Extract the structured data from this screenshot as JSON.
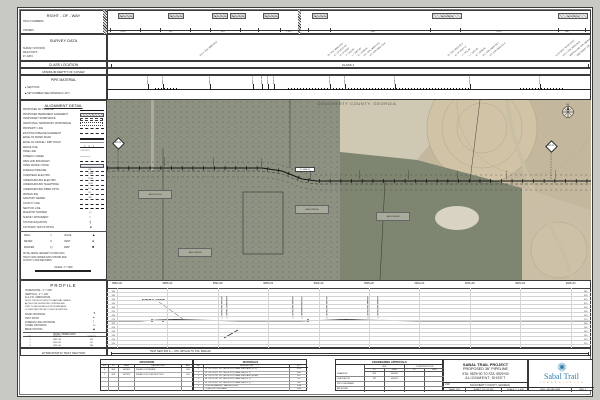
{
  "page": {
    "outer_bg": "#c9c9c3",
    "sheet_bg": "#ffffff",
    "line_color": "#2b2b2b"
  },
  "top": {
    "right_of_way": {
      "title": "RIGHT - OF - WAY",
      "sub1": "TRACT NUMBERS",
      "sub2": "OWNERS",
      "tracts": [
        {
          "x": 118,
          "w": 16,
          "label": "GA-DO-279.000"
        },
        {
          "x": 168,
          "w": 16,
          "label": "GA-DO-280.000"
        },
        {
          "x": 212,
          "w": 16,
          "label": "GA-DO-281.000"
        },
        {
          "x": 230,
          "w": 16,
          "label": "GA-DO-282.000"
        },
        {
          "x": 263,
          "w": 16,
          "label": "GA-DO-283.000"
        },
        {
          "x": 312,
          "w": 16,
          "label": "GA-DO-284.000"
        },
        {
          "x": 432,
          "w": 30,
          "label": "GA-DO-285.000"
        },
        {
          "x": 558,
          "w": 30,
          "label": "GA-DO-287.000"
        }
      ],
      "ticks": [
        110,
        140,
        160,
        190,
        210,
        240,
        258,
        280,
        308,
        330,
        430,
        460,
        558,
        585
      ],
      "distances": [
        {
          "x": 122,
          "label": "1,023'"
        },
        {
          "x": 170,
          "label": "612'"
        },
        {
          "x": 222,
          "label": "418'"
        },
        {
          "x": 288,
          "label": "1,495'"
        },
        {
          "x": 372,
          "label": "2,847'"
        },
        {
          "x": 498,
          "label": "3,214'"
        },
        {
          "x": 566,
          "label": "986'"
        }
      ]
    },
    "survey": {
      "title": "SURVEY DATA",
      "sub1": "SURVEY STATIONS",
      "sub2": "MILE POSTS",
      "sub3": "P.I. DATA",
      "diagonals": [
        {
          "x": 200,
          "text": "P.O.T. STA. 9888+50.0"
        },
        {
          "x": 328,
          "text": "P.I. STA. 9896+45.8"
        },
        {
          "x": 334,
          "text": "Δ = 12°30'15\" RT"
        },
        {
          "x": 340,
          "text": "D = 0°45'00\""
        },
        {
          "x": 346,
          "text": "T = 833.25'"
        },
        {
          "x": 352,
          "text": "L = 1667.00'"
        },
        {
          "x": 358,
          "text": "R = 7639.44'"
        },
        {
          "x": 364,
          "text": "P.C. STA. 9888+12.6"
        },
        {
          "x": 370,
          "text": "P.T. STA. 9904+79.6"
        },
        {
          "x": 448,
          "text": "P.I. STA. 9915+02.3"
        },
        {
          "x": 455,
          "text": "Δ = 8°15'40\" LT"
        },
        {
          "x": 462,
          "text": "T = 551.60'"
        },
        {
          "x": 469,
          "text": "L = 1101.48'"
        },
        {
          "x": 476,
          "text": "R = 7639.44'"
        },
        {
          "x": 483,
          "text": "P.C. STA. 9909+50.7"
        },
        {
          "x": 490,
          "text": "P.T. STA. 9920+52.2"
        },
        {
          "x": 556,
          "text": "N 31°34'21\" W 84°15'12\""
        },
        {
          "x": 563,
          "text": "P.O.T. STA. 9925+00.0"
        },
        {
          "x": 570,
          "text": "MATCH LINE STA. 9929+00"
        },
        {
          "x": 577,
          "text": "SEE SHEET 116"
        }
      ]
    },
    "class_location": {
      "title": "CLASS LOCATION",
      "value": "CLASS 1"
    },
    "depth": {
      "title": "MINIMUM DEPTH OF COVER"
    },
    "pipe_material": {
      "title": "PIPE MATERIAL",
      "bullet1": "SECTIONS",
      "bullet2": "SET NUMBER (SEE MATERIALS LIST)",
      "callouts": [
        {
          "x": 148,
          "t": "9883+10 SET 1"
        },
        {
          "x": 163,
          "t": "9884+55 SET 2"
        },
        {
          "x": 210,
          "t": "9889+62 SET 1"
        },
        {
          "x": 253,
          "t": "9893+95 SET 3"
        },
        {
          "x": 262,
          "t": "9894+88 SET 3"
        },
        {
          "x": 268,
          "t": "9895+40 SET 2"
        },
        {
          "x": 274,
          "t": "9896+02 SET 1"
        },
        {
          "x": 330,
          "t": "9901+66 SET 1"
        },
        {
          "x": 345,
          "t": "9903+18 SET 2"
        },
        {
          "x": 395,
          "t": "9908+25 SET 1"
        },
        {
          "x": 470,
          "t": "9915+80 SET 2"
        },
        {
          "x": 540,
          "t": "9922+91 SET 1"
        }
      ],
      "dot_runs": [
        [
          155,
          178
        ],
        [
          288,
          470
        ],
        [
          520,
          565
        ]
      ]
    }
  },
  "legend": {
    "title": "ALIGNMENT DETAIL",
    "items": [
      {
        "label": "PROPOSED 36\" PIPELINE",
        "sym": "solid2"
      },
      {
        "label": "PROPOSED PERMANENT EASEMENT",
        "sym": "hatchbox"
      },
      {
        "label": "TEMPORARY WORKSPACE",
        "sym": "dashbox"
      },
      {
        "label": "ADDITIONAL TEMPORARY WORKSPACE",
        "sym": "dotbox"
      },
      {
        "label": "PROPERTY LINE",
        "sym": "dashdot"
      },
      {
        "label": "EXISTING PIPELINE EASEMENT",
        "sym": "dashed"
      },
      {
        "label": "EDGE OF PAVED ROAD",
        "sym": "double"
      },
      {
        "label": "EDGE OF GRAVEL / DIRT ROAD",
        "sym": "gray"
      },
      {
        "label": "FENCE LINE",
        "sym": "xline"
      },
      {
        "label": "TREE LINE",
        "sym": "scallop"
      },
      {
        "label": "STREAM / CREEK",
        "sym": "wavy"
      },
      {
        "label": "WETLAND BOUNDARY",
        "sym": "dash"
      },
      {
        "label": "OPEN WATER / POND",
        "sym": "hatch"
      },
      {
        "label": "FOREIGN PIPELINE",
        "sym": "FP"
      },
      {
        "label": "OVERHEAD ELECTRIC",
        "sym": "OHE"
      },
      {
        "label": "UNDERGROUND ELECTRIC",
        "sym": "UGE"
      },
      {
        "label": "UNDERGROUND TELEPHONE",
        "sym": "UGT"
      },
      {
        "label": "UNDERGROUND FIBER OPTIC",
        "sym": "FO"
      },
      {
        "label": "WATER LINE",
        "sym": "W"
      },
      {
        "label": "SANITARY SEWER",
        "sym": "SS"
      },
      {
        "label": "COUNTY LINE",
        "sym": "dd2"
      },
      {
        "label": "SECTION LINE",
        "sym": "longdash"
      },
      {
        "label": "MILEPOST MARKER",
        "sym": "diamond"
      },
      {
        "label": "SURVEY MONUMENT",
        "sym": "circle"
      },
      {
        "label": "STATION EQUATION",
        "sym": "tick"
      },
      {
        "label": "CATHODIC TEST STATION",
        "sym": "square"
      }
    ],
    "symbols2": [
      {
        "label": "WELL",
        "glyph": "○"
      },
      {
        "label": "VALVE",
        "glyph": "▲"
      },
      {
        "label": "METER",
        "glyph": "□"
      },
      {
        "label": "VENT",
        "glyph": "●"
      },
      {
        "label": "MARKER",
        "glyph": "◇"
      },
      {
        "label": "DRIP",
        "glyph": "■"
      }
    ],
    "note_lines": [
      "NOTE: AERIAL IMAGERY FLOWN 2013.",
      "TRACT AND OWNER DATA SHOWN PER",
      "COUNTY LAND RECORDS."
    ],
    "scale_text": "SCALE: 1\" = 600'"
  },
  "map": {
    "county": "DOUGHERTY COUNTY, GEORGIA",
    "compass": "N",
    "mileposts": [
      {
        "x": 118,
        "y": 143,
        "label": "MP 88"
      },
      {
        "x": 551,
        "y": 146,
        "label": "MP 89"
      }
    ],
    "stations": [
      {
        "x": 165,
        "y": 166,
        "label": "9885+00"
      },
      {
        "x": 214,
        "y": 166,
        "label": "9890+00"
      },
      {
        "x": 262,
        "y": 167,
        "label": "9895+00"
      },
      {
        "x": 311,
        "y": 179,
        "label": "9900+00"
      },
      {
        "x": 360,
        "y": 179,
        "label": "9905+00"
      },
      {
        "x": 409,
        "y": 179,
        "label": "9910+00"
      },
      {
        "x": 458,
        "y": 179,
        "label": "9915+00"
      },
      {
        "x": 507,
        "y": 179,
        "label": "9920+00"
      },
      {
        "x": 556,
        "y": 179,
        "label": "9925+00"
      }
    ],
    "owner_boxes": [
      {
        "x": 295,
        "y": 205,
        "label": "GA-DO-282.000"
      },
      {
        "x": 376,
        "y": 212,
        "label": "GA-DO-283.000"
      },
      {
        "x": 138,
        "y": 190,
        "label": "GA-DO-279.000"
      },
      {
        "x": 178,
        "y": 248,
        "label": "GA-DO-280.000"
      }
    ],
    "pi_label": "P.I. 9896+12",
    "pipeline_px": "107,168 262,168 282,171 302,179 317,181 591,181"
  },
  "profile": {
    "title": "PROFILE",
    "scale_h": "HORIZONTAL: 1\" = 600'",
    "scale_v": "VERTICAL: 1\" = 100'",
    "datum": "N.A.V.D. 1988 DATUM",
    "note_lines": [
      "NOTE: PROFILE DEPICTS NATURAL GRADE",
      "ALONG THE SURVEYED CENTERLINE.",
      "PIPE TO BE INSTALLED WITH MINIMUM",
      "COVER PER PROJECT SPECIFICATIONS."
    ],
    "legend": [
      {
        "label": "ROAD CROSSING",
        "glyph": "▼"
      },
      {
        "label": "TEST POINT",
        "glyph": "●"
      },
      {
        "label": "FOREIGN LINE CROSSING",
        "glyph": "|"
      },
      {
        "label": "CASED CROSSING",
        "glyph": "▭"
      },
      {
        "label": "BEND STATION",
        "glyph": "◆"
      }
    ],
    "table": {
      "title": "ROAD / BORE DATA",
      "cols": [
        "NO.",
        "STATION",
        "LENGTH"
      ],
      "widths": [
        14,
        40,
        29
      ],
      "rows": [
        [
          "1",
          "9891+58",
          "120'"
        ],
        [
          "2",
          "9907+81",
          "95'"
        ],
        [
          "3",
          "9921+40",
          "140'"
        ]
      ]
    },
    "stations": [
      "9880+00",
      "9885+00",
      "9890+00",
      "9895+00",
      "9900+00",
      "9905+00",
      "9910+00",
      "9915+00",
      "9920+00",
      "9925+00"
    ],
    "elevations": [
      340,
      330,
      320,
      310,
      300,
      290,
      280,
      270,
      260,
      250,
      240,
      230,
      220,
      210
    ],
    "ground_px": "107,321 140,321 158,320 175,319.5 200,320.2 240,321 300,321 332,320 346,319.4 362,320 420,321 591,321",
    "natural_grade_label": "NATURAL GRADE",
    "crossings": [
      {
        "x": 222,
        "label": "EXISTING DIRT ROAD"
      },
      {
        "x": 227,
        "label": "PROP. TEMP ACCESS ROAD"
      },
      {
        "x": 293,
        "label": "EXISTING FIELD ROAD"
      },
      {
        "x": 302,
        "label": "IRRIGATION PIVOT TRACK"
      },
      {
        "x": 327,
        "label": "EXISTING DIRT ROAD"
      },
      {
        "x": 368,
        "label": "EXISTING FARM DITCH"
      },
      {
        "x": 378,
        "label": "EXISTING FIELD ROAD"
      }
    ],
    "test_points": [
      152,
      163,
      308
    ]
  },
  "hydro": {
    "label": "HYDROSTATIC TEST SECTION",
    "value": "TEST SECTION 9 — STA. 9879+00 TO STA. 9929+00"
  },
  "revisions": {
    "title": "REVISIONS",
    "cols": [
      "NO.",
      "BY",
      "DATE",
      "DESCRIPTION",
      "APP."
    ],
    "widths": [
      8,
      10,
      16,
      47,
      12
    ],
    "rows": [
      [
        "0",
        "MJF",
        "04/24/15",
        "ISSUED FOR REVIEW",
        "JDS"
      ],
      [
        "1",
        "MJF",
        "09/21/15",
        "ISSUED FOR CONSTRUCTION",
        "JDS"
      ],
      [
        "",
        "",
        "",
        "",
        ""
      ],
      [
        "",
        "",
        "",
        "",
        ""
      ],
      [
        "",
        "",
        "",
        "",
        ""
      ]
    ]
  },
  "materials": {
    "title": "MATERIALS",
    "cols": [
      "SET",
      "DESCRIPTION",
      "QTY."
    ],
    "widths": [
      10,
      86,
      18
    ],
    "rows": [
      [
        "1",
        "36\" OD x 0.622\" W.T., API-5L-X70, DSAW, FBE & ARO (CL 1)",
        "3,120'"
      ],
      [
        "2",
        "36\" OD x 0.622\" W.T., API-5L-X70, DSAW, FBE (CL 1)",
        "1,045'"
      ],
      [
        "3",
        "36\" OD x 0.750\" W.T., API-5L-X70, DSAW, FBE & ARO (BORE)",
        "420'"
      ],
      [
        "4",
        "36\" OD x 0.750\" W.T., API-5L-X70, DSAW, FBE (CL 1)",
        "215'"
      ],
      [
        "5",
        "36\" OD x 0.622\" W.T., API-5L-X70, DSAW, FBE (CL 1)",
        "180'"
      ],
      [
        "6",
        "PIPELINE MARKER / WARNING SIGN",
        "6 EA"
      ],
      [
        "",
        "TOTAL PIPE THIS SHEET",
        "5,000'"
      ]
    ]
  },
  "approvals": {
    "title": "ENGINEERING APPROVALS",
    "group1": "BID",
    "group2": "CONSTRUCTION",
    "subcols": [
      "BY",
      "DATE",
      "BY",
      "DATE"
    ],
    "rows": [
      [
        "DRAWN BY",
        "MJF",
        "04/24/15",
        "",
        ""
      ],
      [
        "CHECKED BY",
        "JRT",
        "05/02/15",
        "",
        ""
      ],
      [
        "PROJ. ENGINEER",
        "",
        "",
        "",
        ""
      ],
      [
        "APPROVED",
        "",
        "",
        "",
        ""
      ]
    ]
  },
  "titleblock": {
    "line1": "SABAL TRAIL PROJECT",
    "line2": "PROPOSED 36\" PIPELINE",
    "line3": "STA. 9879+00 TO STA. 9929+00",
    "line4": "ALIGNMENT SHEET",
    "lsd_label": "LSD:",
    "lsd_value": "DOUGHERTY COUNTY, GEORGIA",
    "year": "YEAR: 2017",
    "sheet": "SHEET: 115 OF 449",
    "scale": "SCALE: 1\" = 600'",
    "dwg": "DWG: SBT-AS-0088",
    "rev": "REV: 1"
  },
  "logo": {
    "name": "Sabal Trail",
    "sub": "T R A N S M I S S I O N",
    "blue": "#2f7dad",
    "orange": "#c08a3e"
  }
}
